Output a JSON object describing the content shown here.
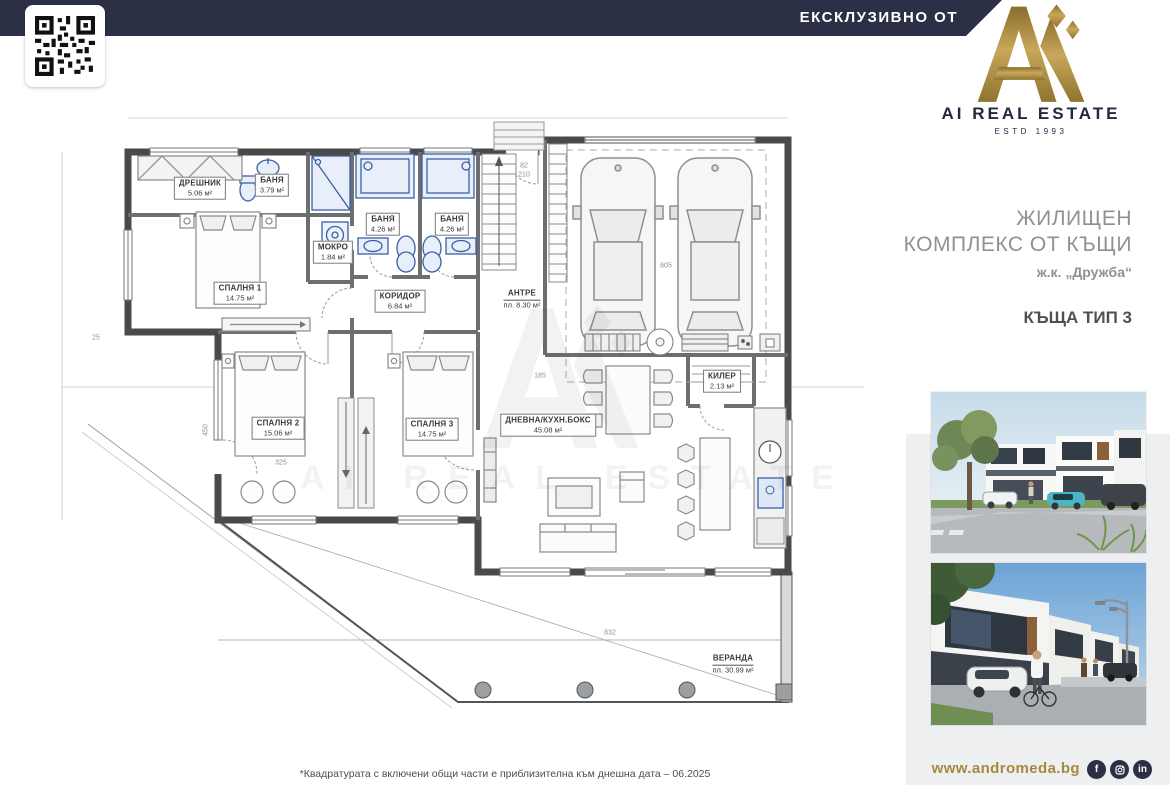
{
  "header": {
    "exclusive_label": "ЕКСКЛУЗИВНО ОТ"
  },
  "brand": {
    "name": "AI REAL ESTATE",
    "estd": "ESTD 1993"
  },
  "listing": {
    "title_line1": "ЖИЛИЩЕН",
    "title_line2": "КОМПЛЕКС ОТ КЪЩИ",
    "subtitle": "ж.к. „Дружба“",
    "type_label": "КЪЩА ТИП 3"
  },
  "plan": {
    "watermark": "AI REAL ESTATE",
    "rooms": [
      {
        "name": "ДРЕШНИК",
        "area": "5.06 м²"
      },
      {
        "name": "БАНЯ",
        "area": "3.79 м²"
      },
      {
        "name": "СПАЛНЯ 1",
        "area": "14.75 м²"
      },
      {
        "name": "МОКРО",
        "area": "1.84 м²"
      },
      {
        "name": "БАНЯ",
        "area": "4.26 м²"
      },
      {
        "name": "БАНЯ",
        "area": "4.26 м²"
      },
      {
        "name": "КОРИДОР",
        "area": "6.84 м²"
      },
      {
        "name": "АНТРЕ",
        "area": "пл. 8.30 м²"
      },
      {
        "name": "СПАЛНЯ 2",
        "area": "15.06 м²"
      },
      {
        "name": "СПАЛНЯ 3",
        "area": "14.75 м²"
      },
      {
        "name": "ДНЕВНА/КУХН.БОКС",
        "area": "45.08 м²"
      },
      {
        "name": "КИЛЕР",
        "area": "2.13 м²"
      },
      {
        "name": "ВЕРАНДА",
        "area": "пл. 30.99 м²"
      }
    ],
    "dimensions": [
      "832",
      "605",
      "450",
      "325",
      "210",
      "82",
      "185",
      "25"
    ]
  },
  "footer": {
    "disclaimer": "*Квадратурата с включени общи части е приблизителна към днешна дата – 06.2025",
    "website": "www.andromeda.bg",
    "social": [
      {
        "name": "facebook",
        "glyph": "f"
      },
      {
        "name": "instagram",
        "glyph": ""
      },
      {
        "name": "linkedin",
        "glyph": "in"
      }
    ]
  },
  "colors": {
    "navy": "#2c3046",
    "gold": "#a5893e",
    "panel": "#edeff0"
  }
}
